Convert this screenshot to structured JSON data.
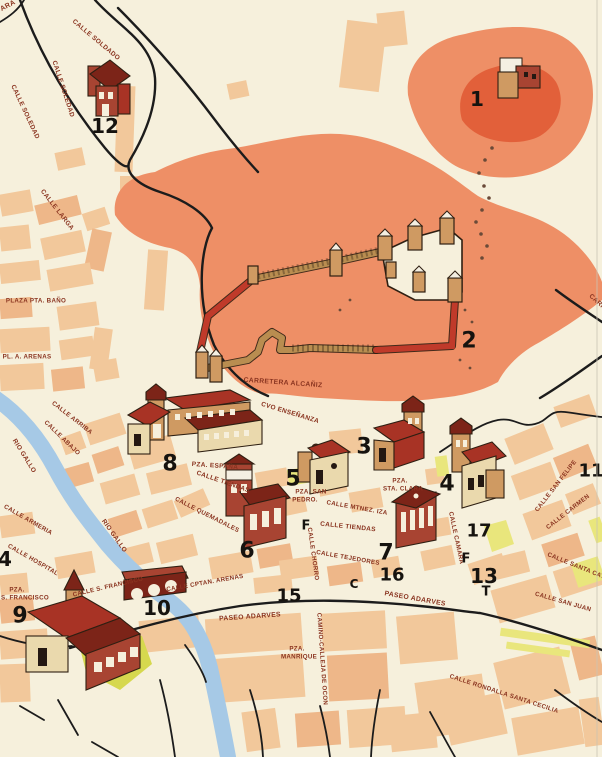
{
  "map": {
    "title": "town-plan",
    "colors": {
      "paper": "#f6f0dc",
      "block": "#f2c89b",
      "block2": "#eeb789",
      "hill": "#ee8f66",
      "hill_dark": "#e2603a",
      "river": "#a6c9e6",
      "park": "#d6d84e",
      "park_light": "#e9e67c",
      "roof": "#a83325",
      "roof_dark": "#7c2418",
      "wall_tan": "#cf9a62",
      "wall_light": "#ead9ad",
      "wall_red": "#a84432",
      "wall_brown": "#b98d50",
      "wall_redseg": "#c03a2a",
      "outline": "#2e1f12",
      "road": "#1c1c1c",
      "label": "#8a3420",
      "label_red": "#c0502c",
      "number": "#16130f"
    },
    "street_labels": [
      {
        "text": "ARA",
        "x": 8,
        "y": 6,
        "rot": -28,
        "size": 7,
        "color": "#c0502c"
      },
      {
        "text": "CALLE SOLDADO",
        "x": 96,
        "y": 40,
        "rot": 40,
        "size": 6.5
      },
      {
        "text": "CALLE SOLEDAD",
        "x": 63,
        "y": 89,
        "rot": 72,
        "size": 6.5
      },
      {
        "text": "CALLE SOLEDAD",
        "x": 25,
        "y": 112,
        "rot": 65,
        "size": 6.5
      },
      {
        "text": "CALLE LARGA",
        "x": 57,
        "y": 210,
        "rot": 52,
        "size": 6.5
      },
      {
        "text": "PLAZA PTA. BAÑO",
        "x": 36,
        "y": 301,
        "rot": 0,
        "size": 6.2
      },
      {
        "text": "PL. A. ARENAS",
        "x": 27,
        "y": 357,
        "rot": 0,
        "size": 6.2
      },
      {
        "text": "CARRETERA ALCAÑIZ",
        "x": 283,
        "y": 383,
        "rot": 4,
        "size": 6.8
      },
      {
        "text": "RIO GALLO",
        "x": 24,
        "y": 456,
        "rot": 58,
        "size": 6.5,
        "color": "#c0502c"
      },
      {
        "text": "RIO GALLO",
        "x": 114,
        "y": 536,
        "rot": 55,
        "size": 6.5,
        "color": "#c0502c"
      },
      {
        "text": "CALLE ARRIBA",
        "x": 72,
        "y": 418,
        "rot": 38,
        "size": 6.2
      },
      {
        "text": "CALLE ABAJO",
        "x": 62,
        "y": 438,
        "rot": 44,
        "size": 6.2
      },
      {
        "text": "CVO ENSEÑANZA",
        "x": 290,
        "y": 413,
        "rot": 17,
        "size": 6.5
      },
      {
        "text": "PZA. ESPAÑA",
        "x": 215,
        "y": 466,
        "rot": 4,
        "size": 6.5
      },
      {
        "text": "CALLE TIENDAS",
        "x": 223,
        "y": 482,
        "rot": 19,
        "size": 6.5
      },
      {
        "text": "PZA. SAN",
        "x": 311,
        "y": 492,
        "rot": 0,
        "size": 6.2
      },
      {
        "text": "PEDRO.",
        "x": 305,
        "y": 500,
        "rot": 0,
        "size": 6.2
      },
      {
        "text": "PZA.",
        "x": 400,
        "y": 481,
        "rot": 0,
        "size": 6.2
      },
      {
        "text": "STA. CLARA",
        "x": 403,
        "y": 489,
        "rot": 0,
        "size": 6.2
      },
      {
        "text": "CALLE MTNEZ. IZA",
        "x": 357,
        "y": 508,
        "rot": 10,
        "size": 6.2
      },
      {
        "text": "CALLE TIENDAS",
        "x": 348,
        "y": 527,
        "rot": 6,
        "size": 6.5
      },
      {
        "text": "CALLE QUEMADALES",
        "x": 207,
        "y": 515,
        "rot": 27,
        "size": 6.2
      },
      {
        "text": "CALLE CHORRO",
        "x": 313,
        "y": 554,
        "rot": 82,
        "size": 6.2
      },
      {
        "text": "CALLE TEJEDORES",
        "x": 348,
        "y": 558,
        "rot": 10,
        "size": 6.2
      },
      {
        "text": "CALLE CPTAN. ARENAS",
        "x": 205,
        "y": 583,
        "rot": -10,
        "size": 6.2
      },
      {
        "text": "CALLE S. FRANCISCO",
        "x": 108,
        "y": 587,
        "rot": -13,
        "size": 6.2
      },
      {
        "text": "PZA.",
        "x": 17,
        "y": 590,
        "rot": 0,
        "size": 6.2
      },
      {
        "text": "S. FRANCISCO",
        "x": 25,
        "y": 598,
        "rot": 0,
        "size": 6.2
      },
      {
        "text": "CALLE HOSPITAL",
        "x": 33,
        "y": 560,
        "rot": 30,
        "size": 6.2
      },
      {
        "text": "CALLE ARMERIA",
        "x": 28,
        "y": 520,
        "rot": 30,
        "size": 6.2
      },
      {
        "text": "PASEO ADARVES",
        "x": 250,
        "y": 617,
        "rot": -4,
        "size": 6.8
      },
      {
        "text": "PASEO ADARVES",
        "x": 415,
        "y": 599,
        "rot": 10,
        "size": 6.8
      },
      {
        "text": "PZA.",
        "x": 297,
        "y": 649,
        "rot": 0,
        "size": 6.2
      },
      {
        "text": "MANRIQUE",
        "x": 299,
        "y": 657,
        "rot": 0,
        "size": 6.2
      },
      {
        "text": "CAMINO-CALLEJA DE OCON",
        "x": 322,
        "y": 659,
        "rot": 86,
        "size": 6.2
      },
      {
        "text": "CALLE SAN FELIPE",
        "x": 556,
        "y": 486,
        "rot": -52,
        "size": 6.2
      },
      {
        "text": "CALLE CARMEN",
        "x": 568,
        "y": 512,
        "rot": -38,
        "size": 6.2
      },
      {
        "text": "CALLE CAMARA",
        "x": 456,
        "y": 538,
        "rot": 78,
        "size": 6.2
      },
      {
        "text": "CALLE SANTA CAT",
        "x": 576,
        "y": 566,
        "rot": 22,
        "size": 6.2
      },
      {
        "text": "CALLE SAN JUAN",
        "x": 563,
        "y": 602,
        "rot": 16,
        "size": 6.2
      },
      {
        "text": "CALLE RONDALLA SANTA CECILIA",
        "x": 504,
        "y": 694,
        "rot": 18,
        "size": 6.2
      },
      {
        "text": "CARRETERA",
        "x": 606,
        "y": 310,
        "rot": 42,
        "size": 6.5
      }
    ],
    "numbers": [
      {
        "text": "1",
        "x": 477,
        "y": 99,
        "size": 20
      },
      {
        "text": "2",
        "x": 469,
        "y": 341,
        "size": 22
      },
      {
        "text": "3",
        "x": 364,
        "y": 447,
        "size": 22
      },
      {
        "text": "4",
        "x": 447,
        "y": 484,
        "size": 22
      },
      {
        "text": "5",
        "x": 293,
        "y": 479,
        "size": 22
      },
      {
        "text": "6",
        "x": 247,
        "y": 551,
        "size": 22
      },
      {
        "text": "7",
        "x": 386,
        "y": 553,
        "size": 22
      },
      {
        "text": "8",
        "x": 170,
        "y": 464,
        "size": 22
      },
      {
        "text": "9",
        "x": 20,
        "y": 616,
        "size": 22
      },
      {
        "text": "10",
        "x": 157,
        "y": 608,
        "size": 20
      },
      {
        "text": "11",
        "x": 591,
        "y": 471,
        "size": 18
      },
      {
        "text": "12",
        "x": 105,
        "y": 126,
        "size": 20
      },
      {
        "text": "13",
        "x": 484,
        "y": 576,
        "size": 20
      },
      {
        "text": "15",
        "x": 289,
        "y": 596,
        "size": 18
      },
      {
        "text": "16",
        "x": 392,
        "y": 575,
        "size": 18
      },
      {
        "text": "17",
        "x": 479,
        "y": 531,
        "size": 18
      },
      {
        "text": "4",
        "x": 5,
        "y": 559,
        "size": 20
      },
      {
        "text": "F",
        "x": 306,
        "y": 526,
        "size": 13
      },
      {
        "text": "F",
        "x": 466,
        "y": 559,
        "size": 13
      },
      {
        "text": "C",
        "x": 354,
        "y": 584,
        "size": 12
      },
      {
        "text": "T",
        "x": 486,
        "y": 592,
        "size": 13
      }
    ]
  }
}
